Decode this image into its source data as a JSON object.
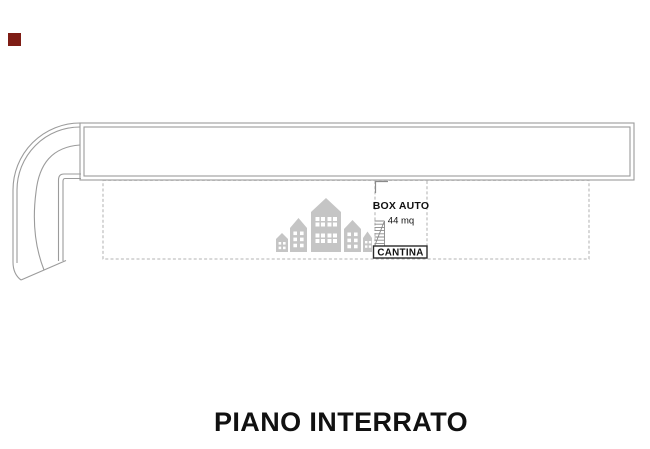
{
  "title": {
    "text": "PIANO INTERRATO"
  },
  "plan": {
    "rooms": {
      "box_auto": {
        "label": "BOX AUTO",
        "area": "44 mq"
      },
      "cantina": {
        "label": "CANTINA"
      }
    }
  },
  "icons": {
    "watermark": "houses-watermark-icon",
    "stairs": "stairs-icon",
    "marker": "red-square-marker"
  },
  "colors": {
    "background": "#ffffff",
    "wall_line": "#9b9b9b",
    "dashed_line": "#b3b3b3",
    "stairs_line": "#8a8a8a",
    "cantina_border": "#2b2b2b",
    "text": "#111111",
    "watermark_gray": "#c5c5c5",
    "marker_red": "#7e1d15"
  }
}
